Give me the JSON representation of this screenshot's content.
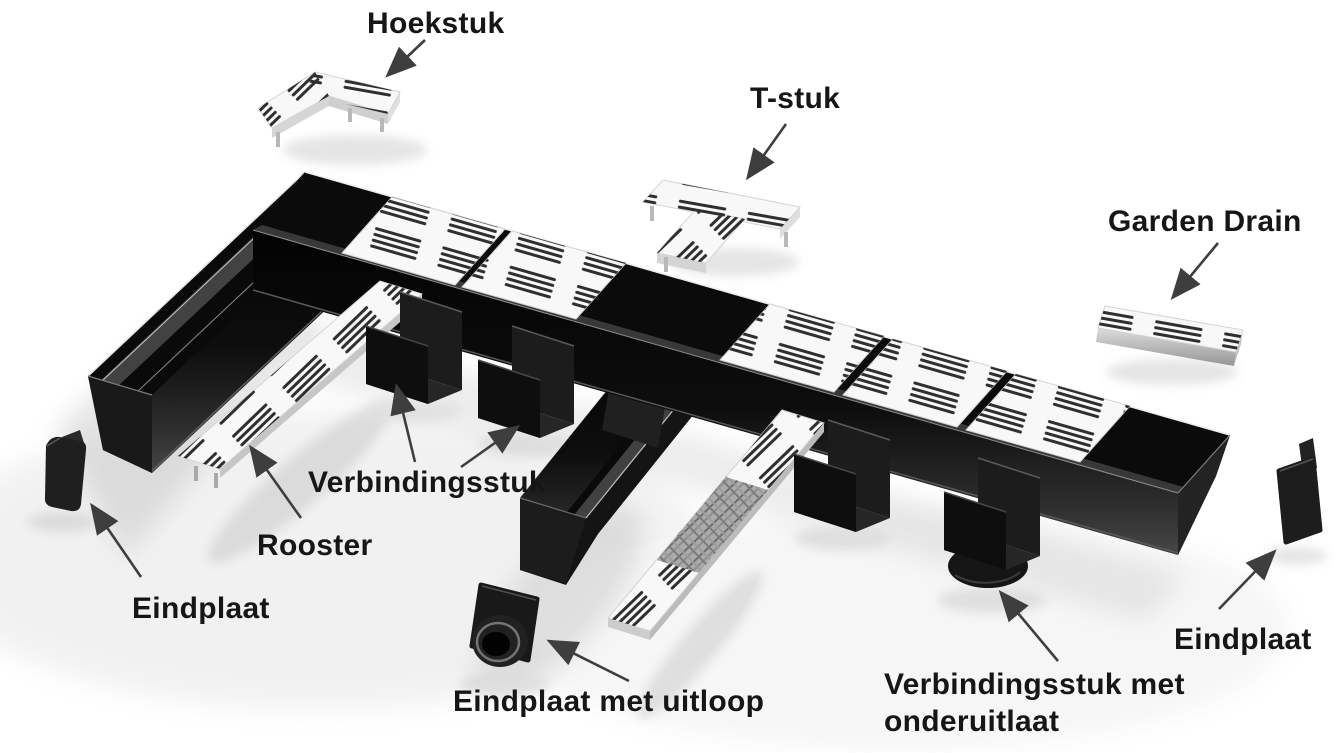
{
  "diagram": {
    "title": "Garden Drain parts diagram",
    "labels": {
      "hoekstuk": "Hoekstuk",
      "t_stuk": "T-stuk",
      "garden_drain": "Garden Drain",
      "verbindingsstuk": "Verbindingsstuk",
      "rooster": "Rooster",
      "eindplaat_left": "Eindplaat",
      "eindplaat_met_uitloop": "Eindplaat met uitloop",
      "verbindingsstuk_met_onderuitlaat": [
        "Verbindingsstuk met",
        "onderuitlaat"
      ],
      "eindplaat_right": "Eindplaat"
    },
    "colors": {
      "background": "#ffffff",
      "text": "#161616",
      "arrow": "#3e3e3e",
      "channel_black": "#141414",
      "grate_white": "#f8f8f8",
      "metal_gray": "#b9b9b9"
    }
  }
}
